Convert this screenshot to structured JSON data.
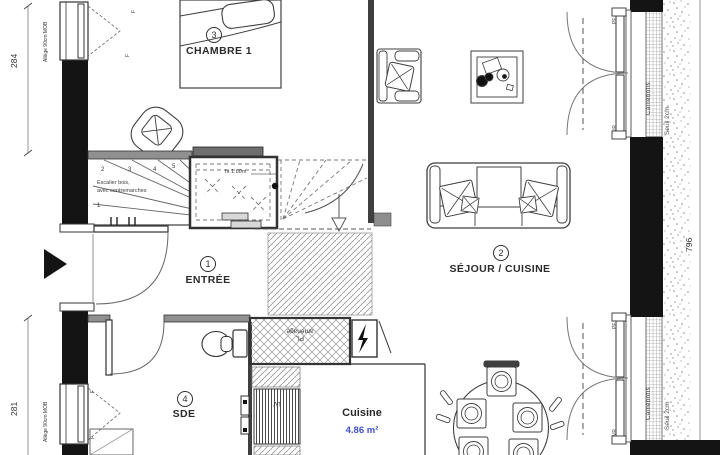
{
  "colors": {
    "area_blue": "#4152c9",
    "wall_black": "#141414",
    "line": "#3f3f3f"
  },
  "rooms": {
    "entree": {
      "num": "1",
      "label": "ENTRÉE"
    },
    "sejour": {
      "num": "2",
      "label": "SÉJOUR / CUISINE"
    },
    "chambre": {
      "num": "3",
      "label": "CHAMBRE 1"
    },
    "sde": {
      "num": "4",
      "label": "SDE"
    }
  },
  "kitchen": {
    "label": "Cuisine",
    "area": "4.86 m²"
  },
  "dims": {
    "left_top": "284",
    "left_bottom": "281",
    "right": "796"
  },
  "stairs": {
    "note_line1": "Escalier bois,",
    "note_line2": "avec contremarches",
    "treads": [
      "1",
      "2",
      "3",
      "4",
      "5"
    ],
    "headroom": "ht 1.80m"
  },
  "labels": {
    "closet_line1": "PL",
    "closet_line2": "aménagé",
    "dishwasher": "LV",
    "window_sill": "Allège 90cm MOB",
    "threshold": "Seuil 2cm",
    "decking": "Caillebotis",
    "french_door": "PF",
    "shutter": "VR",
    "window": "F"
  }
}
